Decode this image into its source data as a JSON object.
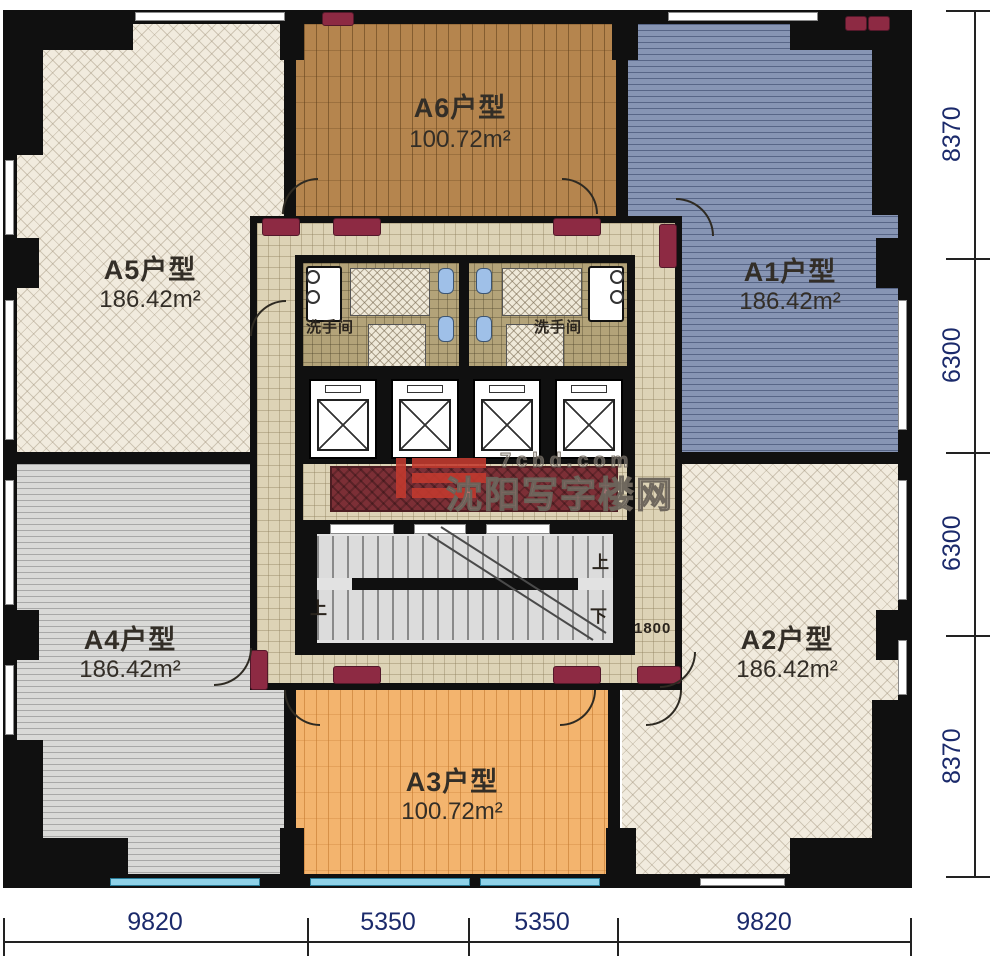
{
  "units": [
    {
      "id": "A1",
      "label": "A1户型",
      "area": "186.42m²"
    },
    {
      "id": "A2",
      "label": "A2户型",
      "area": "186.42m²"
    },
    {
      "id": "A3",
      "label": "A3户型",
      "area": "100.72m²"
    },
    {
      "id": "A4",
      "label": "A4户型",
      "area": "186.42m²"
    },
    {
      "id": "A5",
      "label": "A5户型",
      "area": "186.42m²"
    },
    {
      "id": "A6",
      "label": "A6户型",
      "area": "100.72m²"
    }
  ],
  "core": {
    "washroom_left": "洗手间",
    "washroom_right": "洗手间",
    "stair_up_left": "上",
    "stair_up_right": "上",
    "stair_down": "下",
    "corridor_width": "1800"
  },
  "watermark": {
    "domain": "7cbd.com",
    "site_name": "沈阳写字楼网"
  },
  "dimensions": {
    "right": [
      "8370",
      "6300",
      "6300",
      "8370"
    ],
    "bottom": [
      "9820",
      "5350",
      "5350",
      "9820"
    ]
  },
  "colors": {
    "a1_fill": "#8795b4",
    "a2_fill": "#f1ebde",
    "a3_fill": "#f3b46e",
    "a4_fill": "#d9d9d7",
    "a5_fill": "#f1ebde",
    "a6_fill": "#b5854e",
    "wall": "#101010",
    "corridor_tile": "#ddd3b6",
    "bathroom_tile": "#b3a379",
    "door_mat": "#8d2a43",
    "carpet": "#7c2f36",
    "window_glass": "#8fd2e8",
    "dimension_text": "#1b2a6b"
  }
}
